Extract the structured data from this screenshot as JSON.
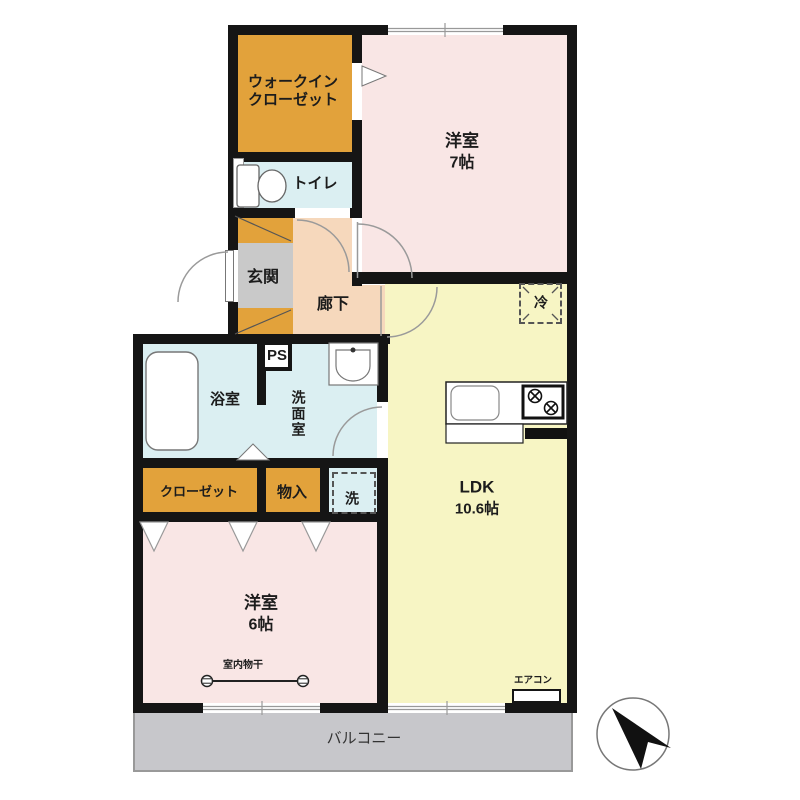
{
  "rooms": {
    "walk_in_closet": {
      "line1": "ウォークイン",
      "line2": "クローゼット"
    },
    "bedroom7": {
      "name": "洋室",
      "size": "7帖"
    },
    "toilet": {
      "label": "トイレ"
    },
    "entrance": {
      "label": "玄関"
    },
    "hallway": {
      "label": "廊下"
    },
    "pipe_space": {
      "label": "PS"
    },
    "fridge": {
      "label": "冷"
    },
    "bathroom": {
      "label": "浴室"
    },
    "washroom": {
      "label": "洗面室"
    },
    "closet": {
      "label": "クローゼット"
    },
    "storage": {
      "label": "物入"
    },
    "washer": {
      "label": "洗"
    },
    "ldk": {
      "name": "LDK",
      "size": "10.6帖"
    },
    "bedroom6": {
      "name": "洋室",
      "size": "6帖"
    },
    "balcony": {
      "label": "バルコニー"
    }
  },
  "annotations": {
    "indoor_drying_rack": "室内物干",
    "air_conditioner": "エアコン"
  },
  "colors": {
    "storage_orange": "#e2a23b",
    "bedroom_pink": "#f9e6e5",
    "ldk_yellow": "#f7f5c4",
    "hallway_peach": "#f6d8bc",
    "wet_area_blue": "#dbeff2",
    "entrance_gray": "#c9c9c9",
    "balcony_gray": "#c7c7cb",
    "wall_black": "#151515"
  }
}
